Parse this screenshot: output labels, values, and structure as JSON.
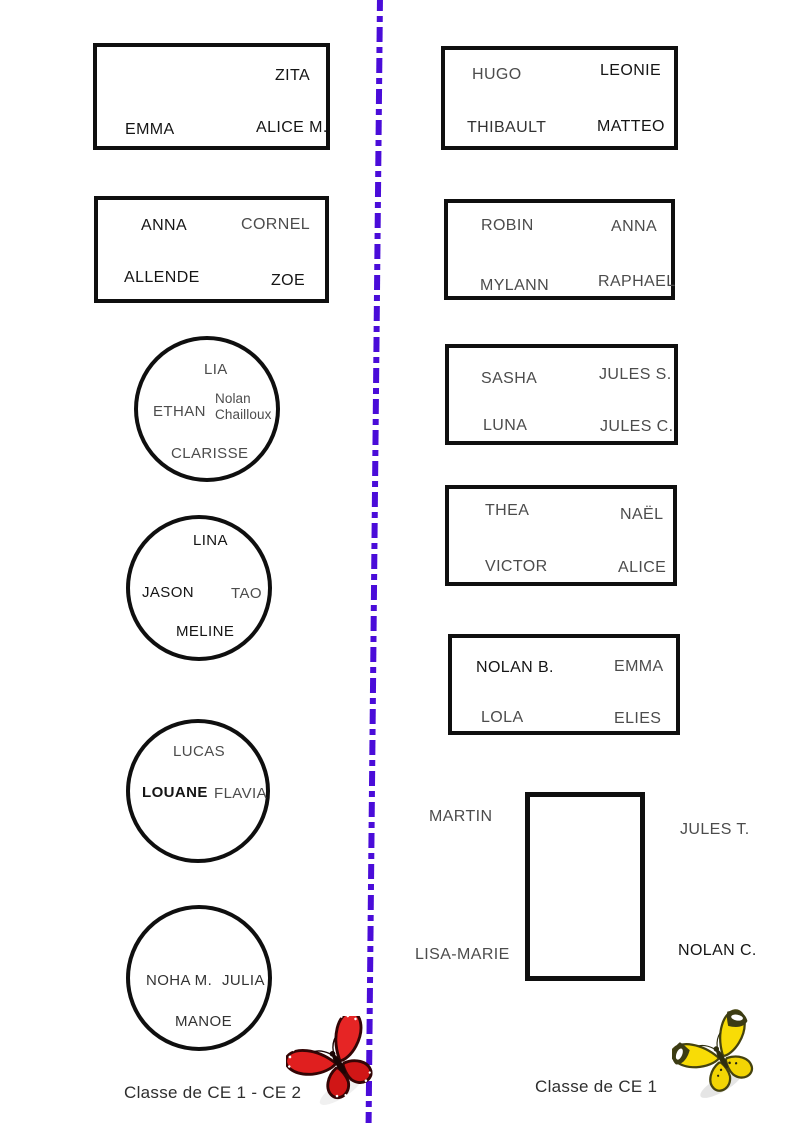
{
  "left_page": {
    "class_label": "Classe de CE 1 - CE 2",
    "table1": {
      "zita": "ZITA",
      "emma": "EMMA",
      "alice_m": "ALICE M."
    },
    "table2": {
      "anna": "ANNA",
      "cornel": "CORNEL",
      "allende": "ALLENDE",
      "zoe": "ZOE"
    },
    "table3": {
      "lia": "LIA",
      "ethan": "ETHAN",
      "nolan_chailloux": "Nolan Chailloux",
      "clarisse": "CLARISSE"
    },
    "table4": {
      "lina": "LINA",
      "jason": "JASON",
      "tao": "TAO",
      "meline": "MELINE"
    },
    "table5": {
      "lucas": "LUCAS",
      "louane": "LOUANE",
      "flavia": "FLAVIA"
    },
    "table6": {
      "noha_m": "NOHA M.",
      "julia": "JULIA",
      "manoe": "MANOE"
    }
  },
  "right_page": {
    "class_label": "Classe de CE 1",
    "table1": {
      "hugo": "HUGO",
      "leonie": "LEONIE",
      "thibault": "THIBAULT",
      "matteo": "MATTEO"
    },
    "table2": {
      "robin": "ROBIN",
      "anna": "ANNA",
      "mylann": "MYLANN",
      "raphael": "RAPHAEL"
    },
    "table3": {
      "sasha": "SASHA",
      "jules_s": "JULES S.",
      "luna": "LUNA",
      "jules_c": "JULES C."
    },
    "table4": {
      "thea": "THEA",
      "nael": "NAËL",
      "victor": "VICTOR",
      "alice": "ALICE"
    },
    "table5": {
      "nolan_b": "NOLAN B.",
      "emma": "EMMA",
      "lola": "LOLA",
      "elies": "ELIES"
    },
    "table6": {
      "martin": "MARTIN",
      "jules_t": "JULES T.",
      "lisa_marie": "LISA-MARIE",
      "nolan_c": "NOLAN C."
    }
  },
  "icons": {
    "left_butterfly": "red-butterfly",
    "right_butterfly": "yellow-butterfly"
  },
  "colors": {
    "divider": "#4a0cd9",
    "table_border": "#0f0f0f",
    "name_dark": "#151515",
    "name_mid": "#333333",
    "name_gray": "#4c4c4c",
    "butterfly_red": "#e01f1f",
    "butterfly_yellow": "#f8dc06"
  }
}
